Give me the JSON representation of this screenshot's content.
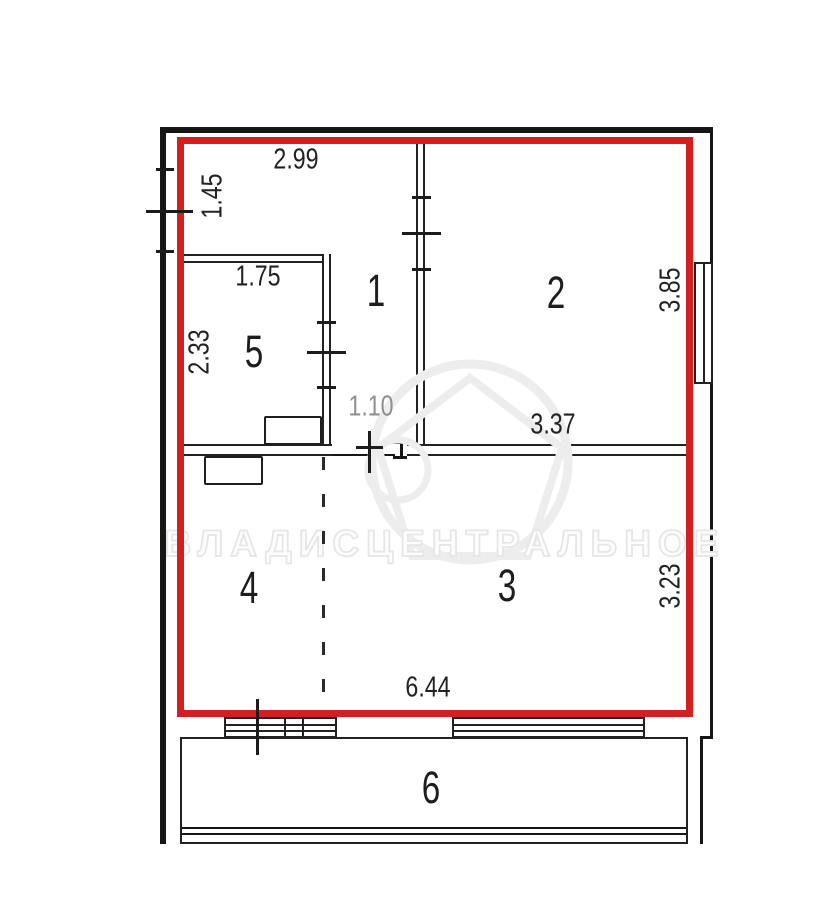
{
  "floorplan": {
    "type": "apartment-floor-plan",
    "highlight_color": "#d21f1f",
    "wall_color": "#1a1a1a",
    "muted_dimension_color": "#8f8f8f",
    "watermark": {
      "text": "ВЛАДИСЦЕНТРАЛЬНОЕ"
    },
    "rooms": [
      {
        "number": "1"
      },
      {
        "number": "2"
      },
      {
        "number": "3"
      },
      {
        "number": "4"
      },
      {
        "number": "5"
      },
      {
        "number": "6"
      }
    ],
    "dimensions": [
      {
        "value": "2.99"
      },
      {
        "value": "1.45"
      },
      {
        "value": "1.75"
      },
      {
        "value": "2.33"
      },
      {
        "value": "3.85"
      },
      {
        "value": "1.10"
      },
      {
        "value": "3.37"
      },
      {
        "value": "3.23"
      },
      {
        "value": "6.44"
      }
    ]
  }
}
